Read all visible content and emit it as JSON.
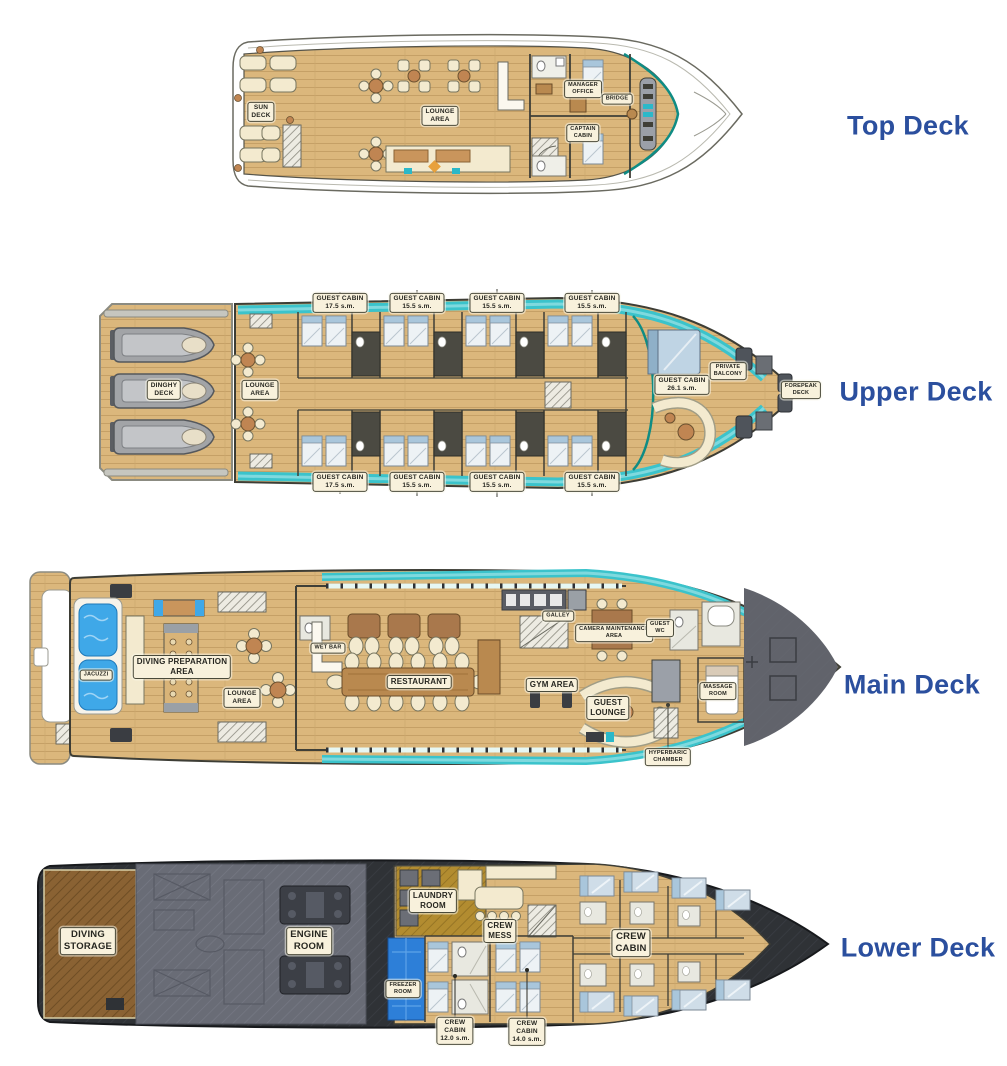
{
  "colors": {
    "deck_name": "#2B4F9E",
    "label_bg": "#F8F1DC",
    "wood": "#DBB77C",
    "teal_walkway": "#3BC3CB",
    "jacuzzi_blue": "#3FA8E8",
    "freezer_blue": "#2D7FD8",
    "engine_gray": "#696C76",
    "storage_brown": "#8A6233",
    "hull_dark": "#2F3236"
  },
  "decks": {
    "top": {
      "name": "Top Deck",
      "labels": {
        "sun_deck": "SUN\nDECK",
        "lounge_area": "LOUNGE\nAREA",
        "manager_office": "MANAGER\nOFFICE",
        "captain_cabin": "CAPTAIN\nCABIN",
        "bridge": "BRIDGE"
      }
    },
    "upper": {
      "name": "Upper Deck",
      "cabin_labels_top": [
        "GUEST CABIN\n17.5 s.m.",
        "GUEST CABIN\n15.5 s.m.",
        "GUEST CABIN\n15.5 s.m.",
        "GUEST CABIN\n15.5 s.m."
      ],
      "cabin_labels_bottom": [
        "GUEST CABIN\n17.5 s.m.",
        "GUEST CABIN\n15.5 s.m.",
        "GUEST CABIN\n15.5 s.m.",
        "GUEST CABIN\n15.5 s.m."
      ],
      "labels": {
        "dinghy_deck": "DINGHY\nDECK",
        "lounge_area": "LOUNGE\nAREA",
        "forward_guest_cabin": "GUEST CABIN\n26.1 s.m.",
        "private_balcony": "PRIVATE\nBALCONY",
        "forepeak_deck": "FOREPEAK\nDECK"
      }
    },
    "main": {
      "name": "Main Deck",
      "labels": {
        "jacuzzi": "JACUZZI",
        "diving_preparation_area": "DIVING PREPARATION\nAREA",
        "lounge_area": "LOUNGE\nAREA",
        "wet_bar": "WET BAR",
        "restaurant": "RESTAURANT",
        "galley": "GALLEY",
        "gym_area": "GYM AREA",
        "camera_maintenance_area": "CAMERA MAINTENANCE\nAREA",
        "guest_wc": "GUEST\nWC",
        "guest_lounge": "GUEST\nLOUNGE",
        "massage_room": "MASSAGE\nROOM",
        "hyperbaric_chamber": "HYPERBARIC\nCHAMBER"
      }
    },
    "lower": {
      "name": "Lower Deck",
      "labels": {
        "diving_storage": "DIVING\nSTORAGE",
        "engine_room": "ENGINE\nROOM",
        "laundry_room": "LAUNDRY\nROOM",
        "crew_mess": "CREW\nMESS",
        "freezer_room": "FREEZER\nROOM",
        "crew_cabin": "CREW\nCABIN",
        "crew_cabin_12": "CREW\nCABIN\n12.0 s.m.",
        "crew_cabin_14": "CREW\nCABIN\n14.0 s.m."
      }
    }
  }
}
